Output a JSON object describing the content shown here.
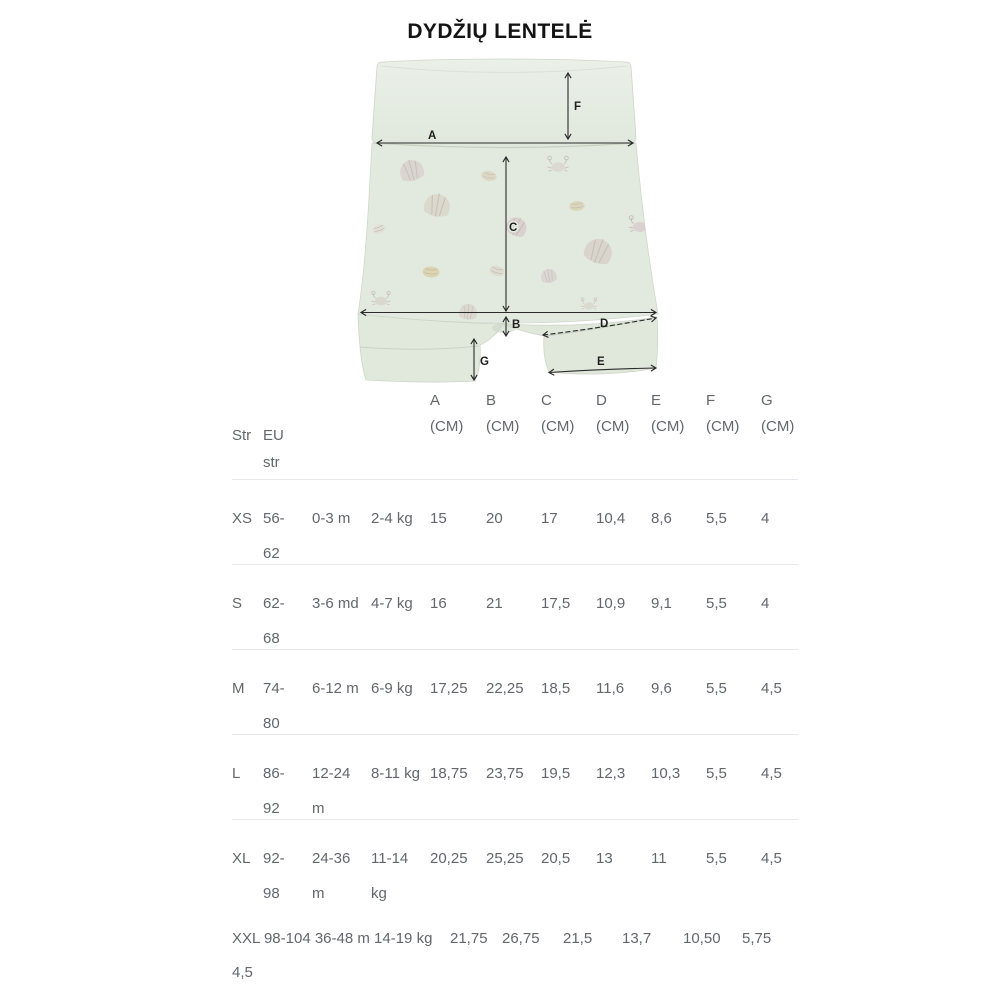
{
  "title": "DYDŽIŲ LENTELĖ",
  "diagram": {
    "measure_labels": [
      "A",
      "B",
      "C",
      "D",
      "E",
      "F",
      "G"
    ],
    "fabric_color": "#e3eae0",
    "cuff_color": "#dfe7da",
    "arrow_color": "#2b2b2b"
  },
  "table": {
    "text_color": "#63666b",
    "divider_color": "#e7e7ee",
    "headers": {
      "size": "Str",
      "eu": "EU\nstr",
      "cols": [
        {
          "letter": "A",
          "unit": "(CM)"
        },
        {
          "letter": "B",
          "unit": "(CM)"
        },
        {
          "letter": "C",
          "unit": "(CM)"
        },
        {
          "letter": "D",
          "unit": "(CM)"
        },
        {
          "letter": "E",
          "unit": "(CM)"
        },
        {
          "letter": "F",
          "unit": "(CM)"
        },
        {
          "letter": "G",
          "unit": "(CM)"
        }
      ]
    },
    "rows": [
      {
        "size": "XS",
        "eu": "56-\n62",
        "age": "0-3 m",
        "weight": "2-4 kg",
        "a": "15",
        "b": "20",
        "c": "17",
        "d": "10,4",
        "e": "8,6",
        "f": "5,5",
        "g": "4"
      },
      {
        "size": "S",
        "eu": "62-\n68",
        "age": "3-6 md",
        "weight": "4-7 kg",
        "a": "16",
        "b": "21",
        "c": "17,5",
        "d": "10,9",
        "e": "9,1",
        "f": "5,5",
        "g": "4"
      },
      {
        "size": "M",
        "eu": "74-\n80",
        "age": "6-12 m",
        "weight": "6-9 kg",
        "a": "17,25",
        "b": "22,25",
        "c": "18,5",
        "d": "11,6",
        "e": "9,6",
        "f": "5,5",
        "g": "4,5"
      },
      {
        "size": "L",
        "eu": "86-\n92",
        "age": "12-24\nm",
        "weight": "8-11 kg",
        "a": "18,75",
        "b": "23,75",
        "c": "19,5",
        "d": "12,3",
        "e": "10,3",
        "f": "5,5",
        "g": "4,5"
      },
      {
        "size": "XL",
        "eu": "92-\n98",
        "age": "24-36\nm",
        "weight": "11-14\nkg",
        "a": "20,25",
        "b": "25,25",
        "c": "20,5",
        "d": "13",
        "e": "11",
        "f": "5,5",
        "g": "4,5"
      }
    ],
    "xxl_row": {
      "label": "XXL 98-104 36-48 m 14-19 kg",
      "values": [
        "21,75",
        "26,75",
        "21,5",
        "13,7",
        "10,50",
        "5,75"
      ],
      "wrapped": "4,5"
    }
  }
}
